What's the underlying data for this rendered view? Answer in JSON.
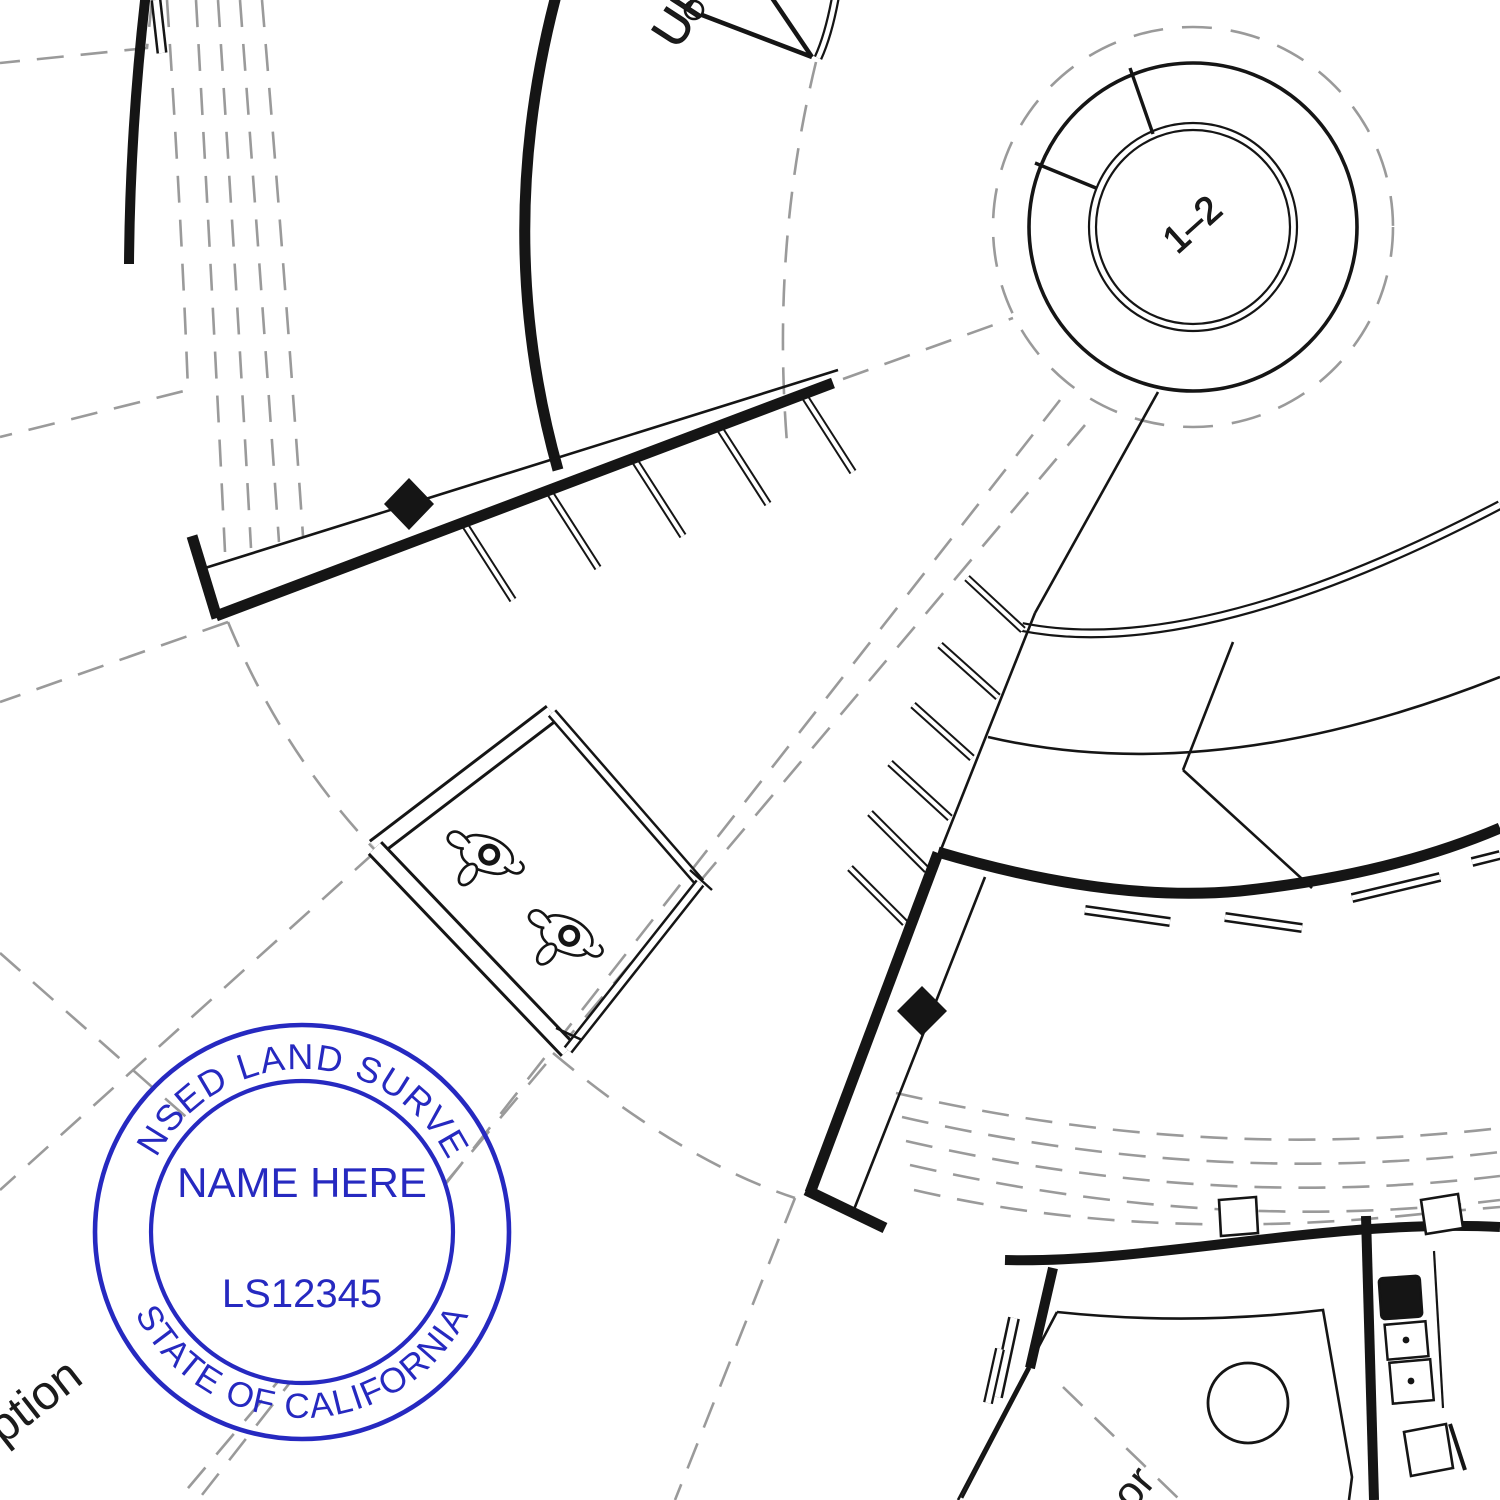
{
  "document": {
    "type": "architectural-floor-plan-with-surveyor-stamp",
    "background_color": "#ffffff"
  },
  "plan": {
    "labels": {
      "up": "UP",
      "stair_range": "1–2",
      "reception_partial": "eption",
      "corridor_partial": "or"
    },
    "colors": {
      "line": "#151515",
      "dashed_guide": "#9a9a9a",
      "background": "#ffffff"
    },
    "symbols": {
      "people_figures": 2,
      "column_diamonds": 2,
      "grid_column_squares": 2,
      "sinks": 2,
      "stove": 1,
      "round_table": 1
    }
  },
  "stamp": {
    "arc_top": "LICENSED LAND SURVEYOR",
    "name_line": "NAME HERE",
    "license_line": "LS12345",
    "arc_bottom": "STATE OF CALIFORNIA",
    "color": "#2629c0"
  }
}
